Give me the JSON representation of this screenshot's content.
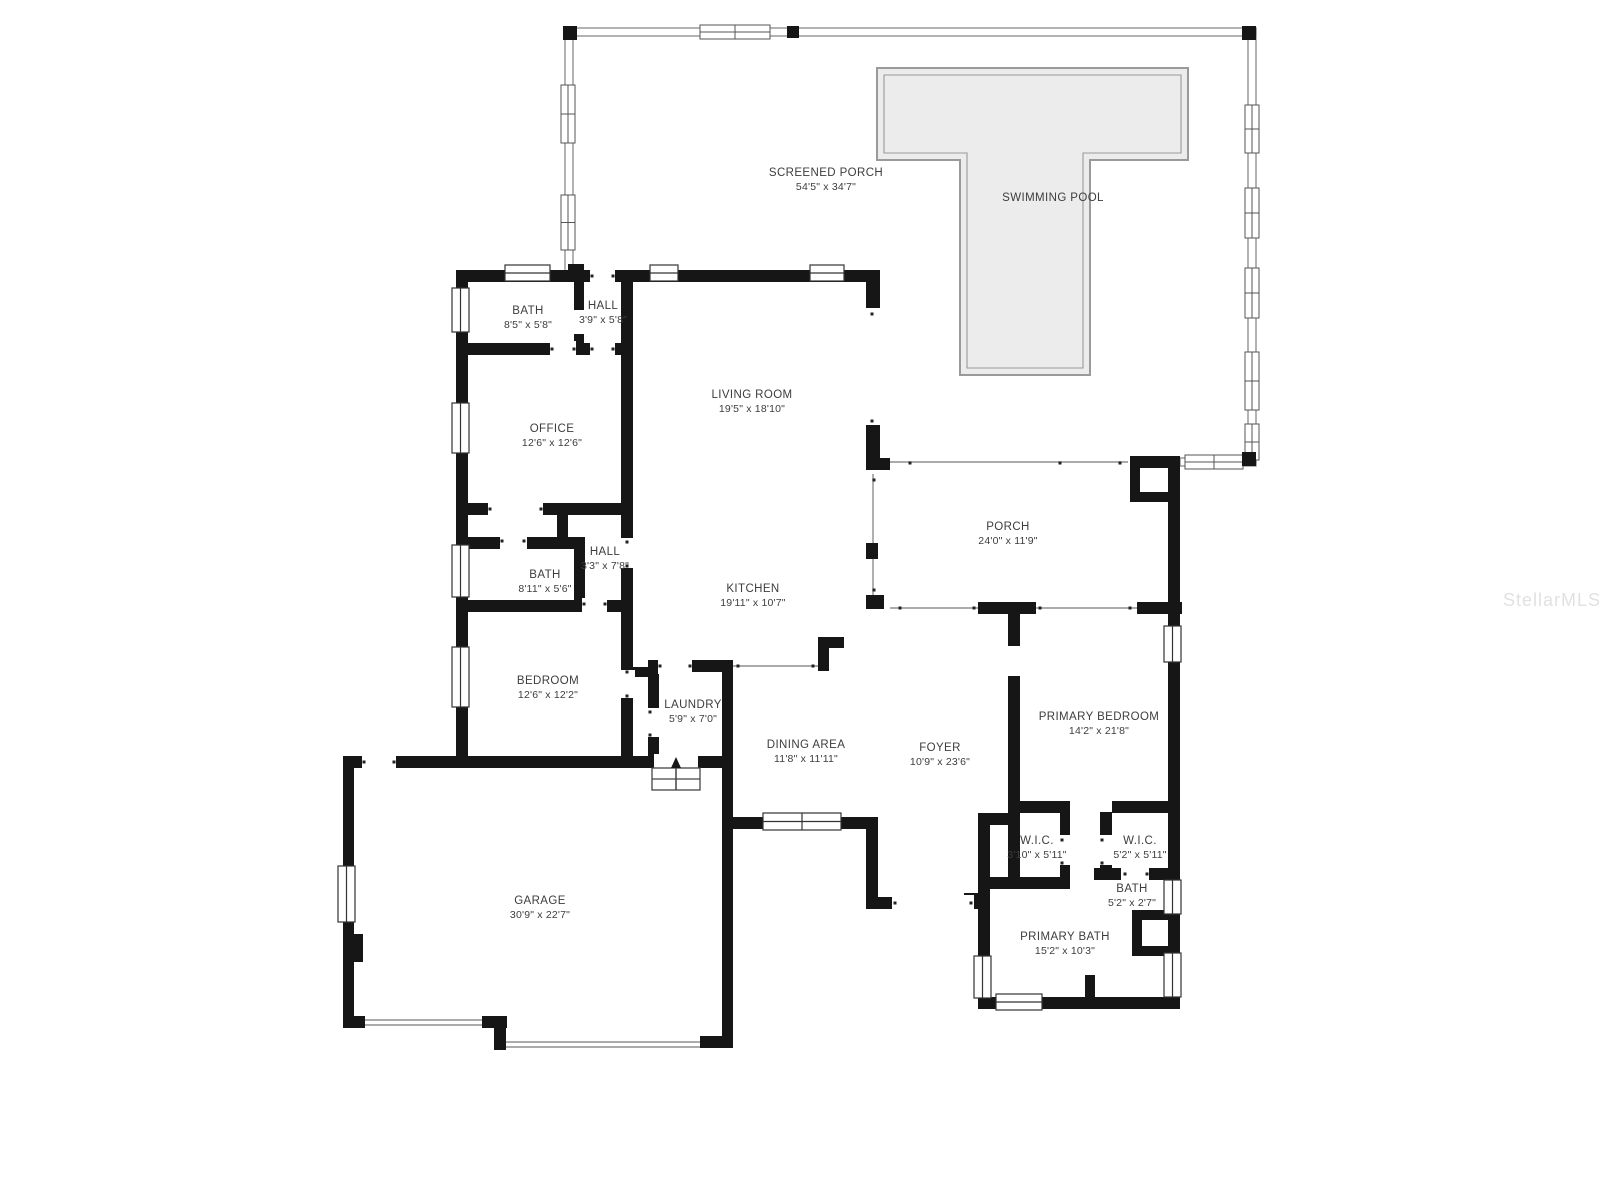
{
  "watermark": {
    "text": "StellarMLS"
  },
  "rooms": [
    {
      "id": "screened-porch",
      "name": "SCREENED PORCH",
      "dims": "54'5\" x 34'7\""
    },
    {
      "id": "swimming-pool",
      "name": "SWIMMING POOL",
      "dims": ""
    },
    {
      "id": "bath-top",
      "name": "BATH",
      "dims": "8'5\" x 5'8\""
    },
    {
      "id": "hall-top",
      "name": "HALL",
      "dims": "3'9\" x 5'8\""
    },
    {
      "id": "office",
      "name": "OFFICE",
      "dims": "12'6\" x 12'6\""
    },
    {
      "id": "living-room",
      "name": "LIVING ROOM",
      "dims": "19'5\" x 18'10\""
    },
    {
      "id": "hall-middle",
      "name": "HALL",
      "dims": "3'3\" x 7'8\""
    },
    {
      "id": "bath-middle",
      "name": "BATH",
      "dims": "8'11\" x 5'6\""
    },
    {
      "id": "kitchen",
      "name": "KITCHEN",
      "dims": "19'11\" x 10'7\""
    },
    {
      "id": "porch",
      "name": "PORCH",
      "dims": "24'0\" x 11'9\""
    },
    {
      "id": "bedroom",
      "name": "BEDROOM",
      "dims": "12'6\" x 12'2\""
    },
    {
      "id": "laundry",
      "name": "LAUNDRY",
      "dims": "5'9\" x 7'0\""
    },
    {
      "id": "dining-area",
      "name": "DINING AREA",
      "dims": "11'8\" x 11'11\""
    },
    {
      "id": "foyer",
      "name": "FOYER",
      "dims": "10'9\" x 23'6\""
    },
    {
      "id": "primary-bedroom",
      "name": "PRIMARY BEDROOM",
      "dims": "14'2\" x 21'8\""
    },
    {
      "id": "wic-left",
      "name": "W.I.C.",
      "dims": "3'10\" x 5'11\""
    },
    {
      "id": "wic-right",
      "name": "W.I.C.",
      "dims": "5'2\" x 5'11\""
    },
    {
      "id": "bath-small",
      "name": "BATH",
      "dims": "5'2\" x 2'7\""
    },
    {
      "id": "primary-bath",
      "name": "PRIMARY BATH",
      "dims": "15'2\" x 10'3\""
    },
    {
      "id": "garage",
      "name": "GARAGE",
      "dims": "30'9\" x 22'7\""
    }
  ]
}
